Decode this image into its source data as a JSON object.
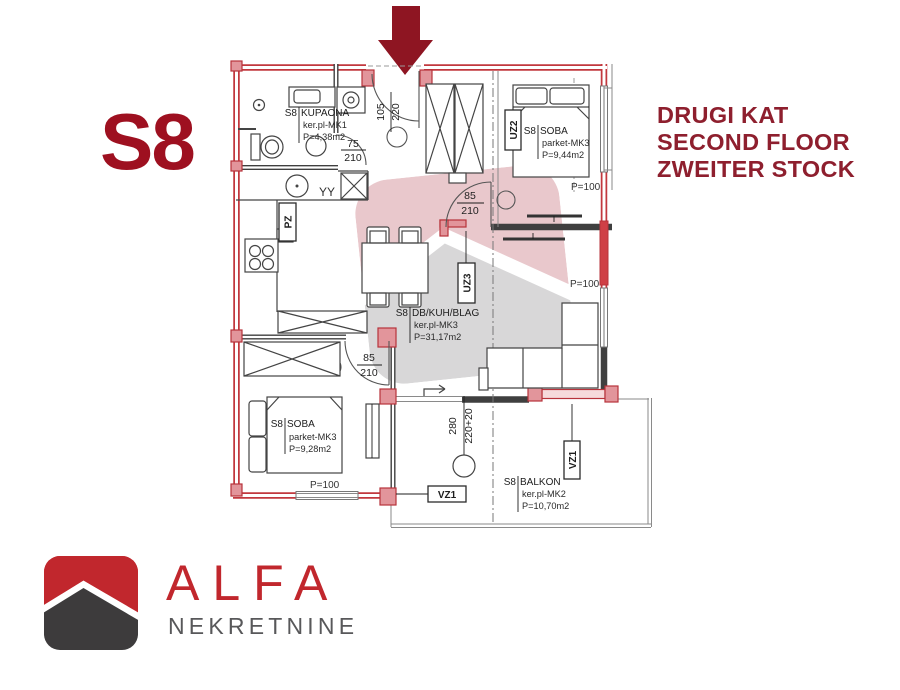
{
  "colors": {
    "title_red": "#9e1020",
    "heading_red": "#8e1f2e",
    "arrow_red": "#8e1522",
    "wall_red": "#c2383e",
    "line_dark": "#3f3f3f",
    "logo_red": "#c1272d",
    "logo_gray": "#3d3b3c",
    "logo_text_gray": "#58585a"
  },
  "unit_label": "S8",
  "heading": {
    "hr": "DRUGI KAT",
    "en": "SECOND FLOOR",
    "de": "ZWEITER STOCK"
  },
  "rooms": {
    "kupaona": {
      "code": "S8",
      "name": "KUPAONA",
      "finish": "ker.pl-MK1",
      "area": "P=4,38m2"
    },
    "soba_top": {
      "code": "S8",
      "name": "SOBA",
      "finish": "parket-MK3",
      "area": "P=9,44m2"
    },
    "living": {
      "code": "S8",
      "name": "DB/KUH/BLAG",
      "finish": "ker.pl-MK3",
      "area": "P=31,17m2"
    },
    "soba_bottom": {
      "code": "S8",
      "name": "SOBA",
      "finish": "parket-MK3",
      "area": "P=9,28m2"
    },
    "balkon": {
      "code": "S8",
      "name": "BALKON",
      "finish": "ker.pl-MK2",
      "area": "P=10,70m2"
    }
  },
  "doors": {
    "entrance": {
      "w": "105",
      "h": "220"
    },
    "bathroom": {
      "w": "75",
      "h": "210"
    },
    "hall": {
      "w": "85",
      "h": "210"
    },
    "bedroom": {
      "w": "85",
      "h": "210"
    }
  },
  "balcony_dim": {
    "a": "280",
    "b": "220+20"
  },
  "tags": {
    "pz": "PZ",
    "uz2": "UZ2",
    "uz3": "UZ3",
    "vz1_left": "VZ1",
    "vz1_right": "VZ1"
  },
  "parapet": {
    "p1": "P=100",
    "p2": "P=100",
    "p3": "P=100"
  },
  "kitchen": {
    "glasses": "YY"
  },
  "logo": {
    "brand": "ALFA",
    "subtitle": "NEKRETNINE"
  }
}
